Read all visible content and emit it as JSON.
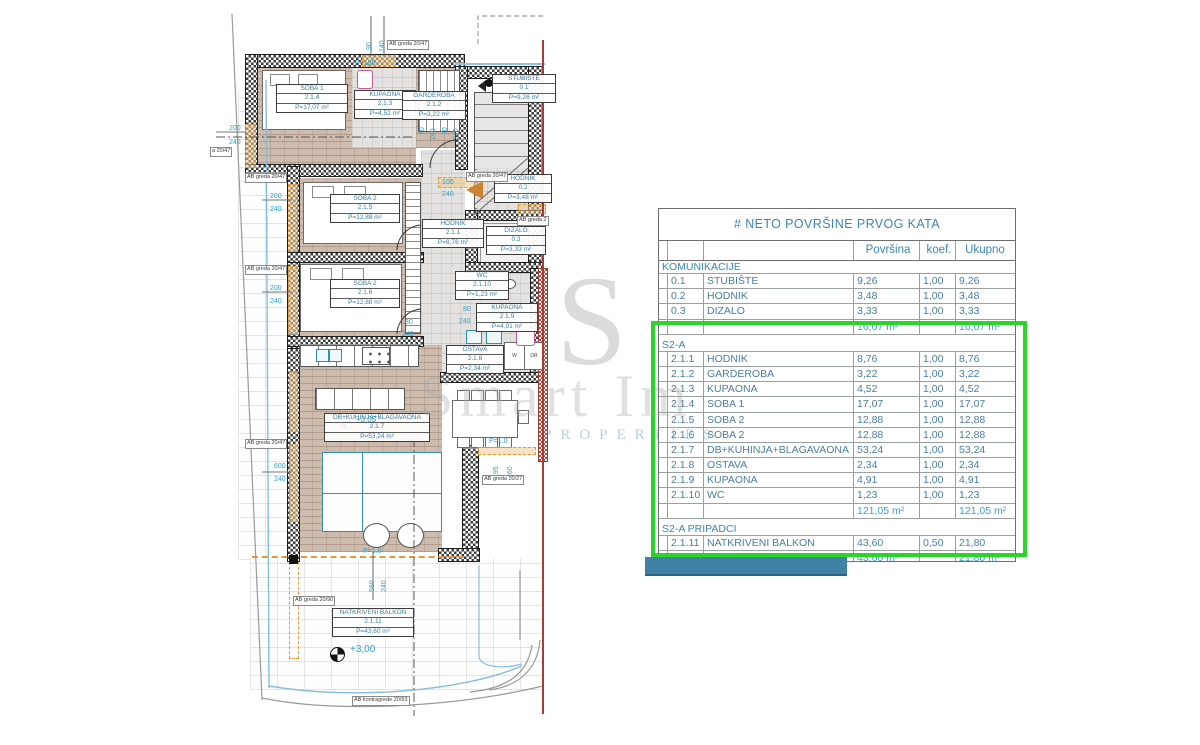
{
  "title": "# NETO POVRŠINE PRVOG KATA",
  "colors": {
    "highlight_green": "#2bd42b",
    "bar_blue": "#4181a6",
    "total_red": "#e8736a",
    "subtotal_blue": "#3f9ecd",
    "table_blue": "#3b85b0",
    "dim_teal": "#35a0c4",
    "section_line_red": "#a63c34"
  },
  "watermark": {
    "monogram": "S",
    "line1": "Smart Im",
    "line2": "PROPERTIES"
  },
  "plan": {
    "rooms": {
      "soba1": {
        "name": "SOBA 1",
        "code": "2.1.4",
        "area": "P=17,07 m²"
      },
      "kupaona1": {
        "name": "KUPAONA",
        "code": "2.1.3",
        "area": "P=4,52 m²"
      },
      "garderoba": {
        "name": "GARDEROBA",
        "code": "2.1.2",
        "area": "P=3,22 m²"
      },
      "stubiste": {
        "name": "STUBIŠTE",
        "code": "0.1",
        "area": "P=9,26 m²"
      },
      "hodnik02": {
        "name": "HODNIK",
        "code": "0.2",
        "area": "P=3,48 m²"
      },
      "soba2a": {
        "name": "SOBA 2",
        "code": "2.1.5",
        "area": "P=12,88 m²"
      },
      "hodnik211": {
        "name": "HODNIK",
        "code": "2.1.1",
        "area": "P=8,76 m²"
      },
      "dizalo": {
        "name": "DIZALO",
        "code": "0.3",
        "area": "P=3,33 m²"
      },
      "soba2b": {
        "name": "SOBA 2",
        "code": "2.1.6",
        "area": "P=12,88 m²"
      },
      "wc": {
        "name": "WC",
        "code": "2.1.10",
        "area": "P=1,23 m²"
      },
      "kupaona2": {
        "name": "KUPAONA",
        "code": "2.1.9",
        "area": "P=4,91 m²"
      },
      "ostava": {
        "name": "OSTAVA",
        "code": "2.1.8",
        "area": "P=2,34 m²"
      },
      "dnevni": {
        "name": "DB+KUHINJA+BLAGAVAONA",
        "code": "2.1.7",
        "area": "P=53,24 m²"
      },
      "balkon": {
        "name": "NATKRIVENI BALKON",
        "code": "2.1.11",
        "area": "P=43,60 m²"
      }
    },
    "dims": {
      "d90": "90",
      "d140": "140",
      "p100": "P=100",
      "l200a": "200",
      "l240a": "240",
      "l200b": "200",
      "l240b": "240",
      "l200c": "200",
      "l240c": "240",
      "g70a": "70",
      "g240a": "240",
      "g70b": "70",
      "g240b": "240",
      "e100": "100",
      "e240": "240",
      "s80a": "80",
      "s240a": "240",
      "k80": "80",
      "k240": "240",
      "v600": "600",
      "v240": "240",
      "t195": "195",
      "t260": "260",
      "b580": "580",
      "b240": "240",
      "lvl_balkon": "+3,00",
      "lvl_living": "+3,05",
      "par1": "P=1.0",
      "par2": "P=1.0",
      "cut": "a 20/47"
    },
    "beams": {
      "ab1": "AB greda 20/47",
      "ab2": "AB greda 20/47",
      "ab3": "AB greda 20/47",
      "ab4": "AB greda 20/47",
      "ab5": "AB greda 20/47",
      "ab6": "AB greda 2",
      "ab7": "AB greda 20/27",
      "ab8": "AB greda 20/90",
      "ab9": "AB kontragrede 20/93"
    },
    "closets": {
      "w": "W",
      "dr": "DR"
    }
  },
  "table": {
    "title": "# NETO POVRŠINE PRVOG KATA",
    "columns": [
      "Površina",
      "koef.",
      "Ukupno"
    ],
    "rows": [
      {
        "kind": "section",
        "label": "KOMUNIKACIJE"
      },
      {
        "kind": "item",
        "num": "0.1",
        "name": "STUBIŠTE",
        "area": "9,26",
        "koef": "1,00",
        "total": "9,26"
      },
      {
        "kind": "item",
        "num": "0.2",
        "name": "HODNIK",
        "area": "3,48",
        "koef": "1,00",
        "total": "3,48"
      },
      {
        "kind": "item",
        "num": "0.3",
        "name": "DIZALO",
        "area": "3,33",
        "koef": "1,00",
        "total": "3,33"
      },
      {
        "kind": "subtotal",
        "area": "16,07 m²",
        "total": "16,07 m²"
      },
      {
        "kind": "gap"
      },
      {
        "kind": "section",
        "label": "S2-A"
      },
      {
        "kind": "item",
        "num": "2.1.1",
        "name": "HODNIK",
        "area": "8,76",
        "koef": "1,00",
        "total": "8,76"
      },
      {
        "kind": "item",
        "num": "2.1.2",
        "name": "GARDEROBA",
        "area": "3,22",
        "koef": "1,00",
        "total": "3,22"
      },
      {
        "kind": "item",
        "num": "2.1.3",
        "name": "KUPAONA",
        "area": "4,52",
        "koef": "1,00",
        "total": "4,52"
      },
      {
        "kind": "item",
        "num": "2.1.4",
        "name": "SOBA 1",
        "area": "17,07",
        "koef": "1,00",
        "total": "17,07"
      },
      {
        "kind": "item",
        "num": "2.1.5",
        "name": "SOBA 2",
        "area": "12,88",
        "koef": "1,00",
        "total": "12,88"
      },
      {
        "kind": "item",
        "num": "2.1.6",
        "name": "SOBA 2",
        "area": "12,88",
        "koef": "1,00",
        "total": "12,88"
      },
      {
        "kind": "item",
        "num": "2.1.7",
        "name": "DB+KUHINJA+BLAGAVAONA",
        "area": "53,24",
        "koef": "1,00",
        "total": "53,24"
      },
      {
        "kind": "item",
        "num": "2.1.8",
        "name": "OSTAVA",
        "area": "2,34",
        "koef": "1,00",
        "total": "2,34"
      },
      {
        "kind": "item",
        "num": "2.1.9",
        "name": "KUPAONA",
        "area": "4,91",
        "koef": "1,00",
        "total": "4,91"
      },
      {
        "kind": "item",
        "num": "2.1.10",
        "name": "WC",
        "area": "1,23",
        "koef": "1,00",
        "total": "1,23"
      },
      {
        "kind": "subtotal",
        "area": "121,05 m²",
        "total": "121,05 m²"
      },
      {
        "kind": "gap"
      },
      {
        "kind": "section",
        "label": "S2-A PRIPADCI"
      },
      {
        "kind": "item",
        "num": "2.1.11",
        "name": "NATKRIVENI BALKON",
        "area": "43,60",
        "koef": "0,50",
        "total": "21,80"
      },
      {
        "kind": "subtotal",
        "area": "43,60 m²",
        "total": "21,80 m²"
      },
      {
        "kind": "gap"
      },
      {
        "kind": "total",
        "area": "180,72 m²",
        "total": "158,92 m²"
      }
    ]
  }
}
